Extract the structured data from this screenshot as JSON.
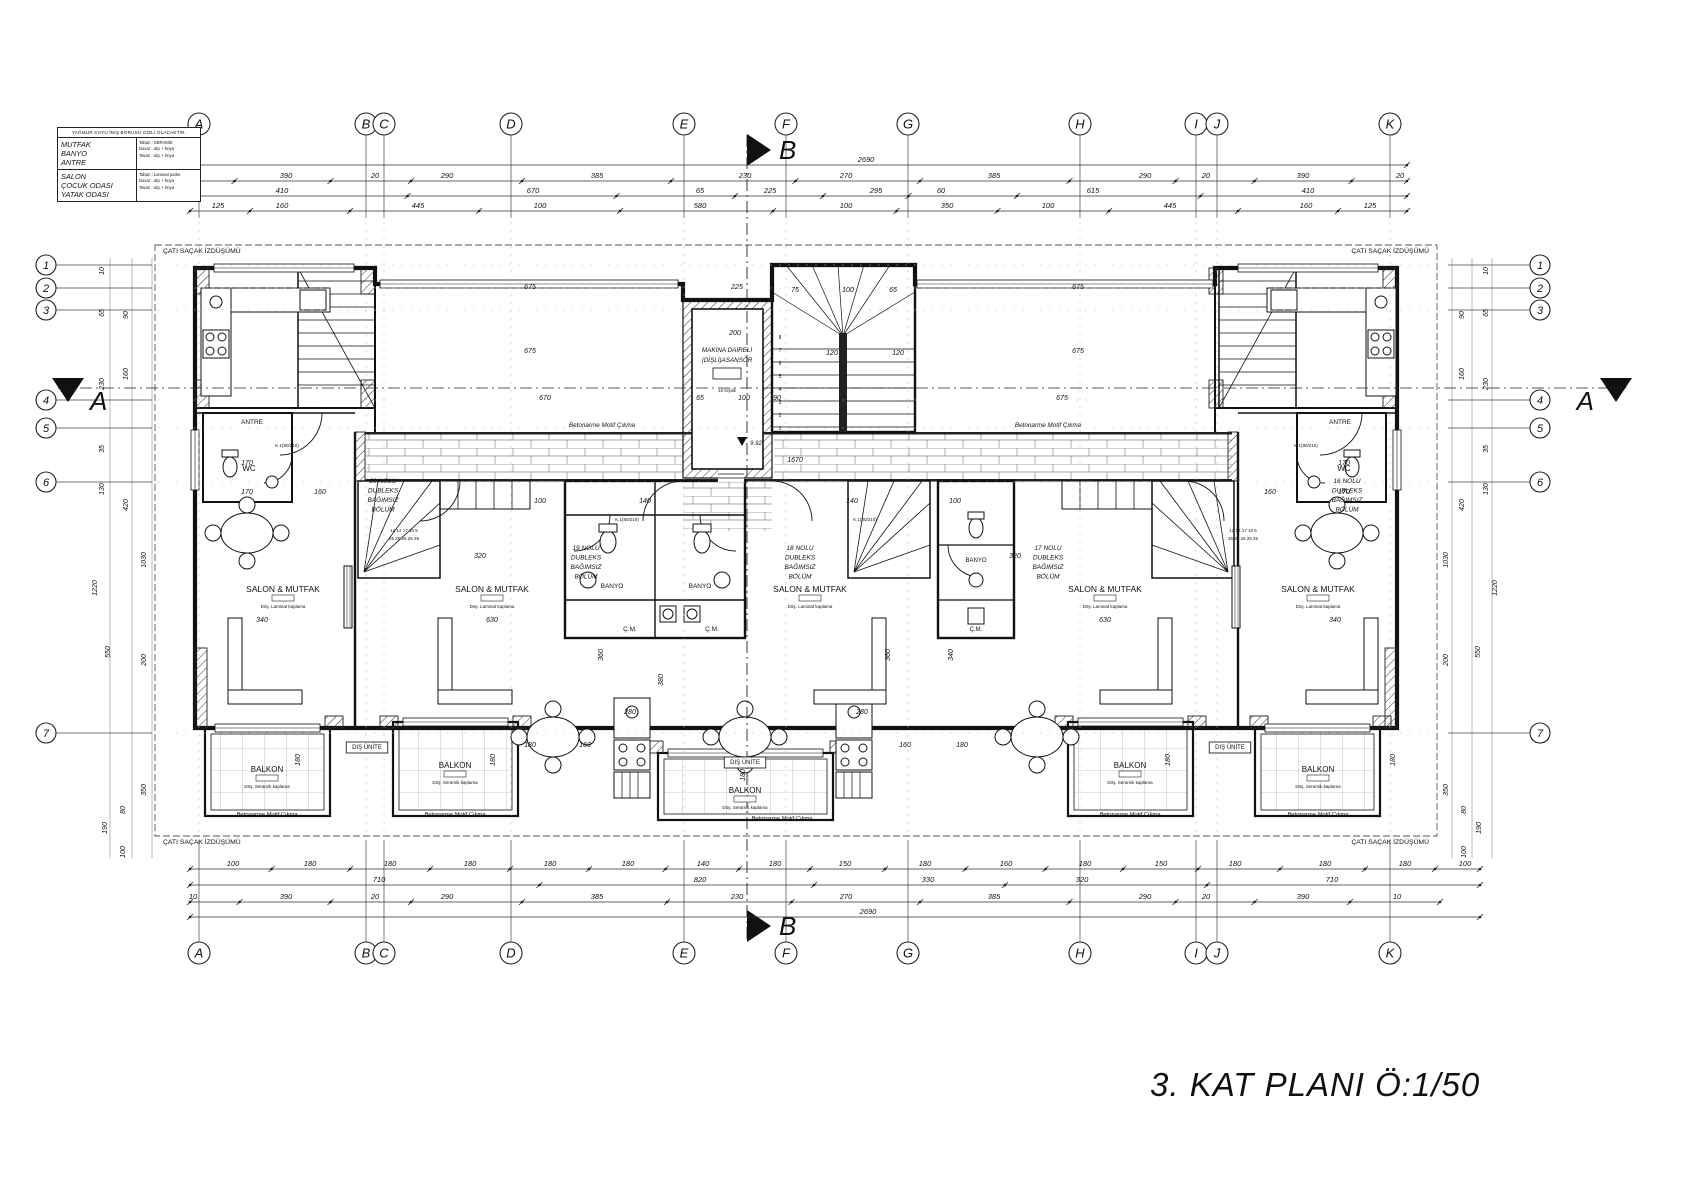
{
  "title": {
    "text": "3. KAT PLANI  Ö:1/50"
  },
  "legend": {
    "header": "YAĞMUR SUYU İNİŞ BORUSU GİZLİ OLACAKTIR.",
    "rows": [
      {
        "rooms": "MUTFAK\nBANYO\nANTRE",
        "finish": "Taban : SERAMİK\nDuvar : alçı + boya\nTavan : alçı + boya"
      },
      {
        "rooms": "SALON\nÇOCUK ODASI\nYATAK ODASI",
        "finish": "Taban : Laminat parke\nDuvar : alçı + boya\nTavan : alçı + boya"
      }
    ]
  },
  "axes": {
    "top_y": 124,
    "bottom_y": 953,
    "left_x": 46,
    "right_x": 1540,
    "letters": [
      {
        "label": "A",
        "x": 199
      },
      {
        "label": "B",
        "x": 366
      },
      {
        "label": "C",
        "x": 384
      },
      {
        "label": "D",
        "x": 511
      },
      {
        "label": "E",
        "x": 684
      },
      {
        "label": "F",
        "x": 786
      },
      {
        "label": "G",
        "x": 908
      },
      {
        "label": "H",
        "x": 1080
      },
      {
        "label": "I",
        "x": 1196
      },
      {
        "label": "J",
        "x": 1217
      },
      {
        "label": "K",
        "x": 1390
      }
    ],
    "numbers": [
      {
        "label": "1",
        "y": 265
      },
      {
        "label": "2",
        "y": 288
      },
      {
        "label": "3",
        "y": 310
      },
      {
        "label": "4",
        "y": 400
      },
      {
        "label": "5",
        "y": 428
      },
      {
        "label": "6",
        "y": 482
      },
      {
        "label": "7",
        "y": 733
      }
    ]
  },
  "sections": {
    "top": {
      "label": "B",
      "x": 747,
      "y": 150
    },
    "bottom": {
      "label": "B",
      "x": 747,
      "y": 926
    },
    "left": {
      "label": "A",
      "x": 68,
      "y": 388
    },
    "right": {
      "label": "A",
      "x": 1616,
      "y": 388
    }
  },
  "dim_rows": [
    {
      "y": 162,
      "x1": 190,
      "x2": 1407,
      "items": [
        {
          "t": "2690",
          "x": 866
        }
      ]
    },
    {
      "y": 178,
      "x1": 190,
      "x2": 1407,
      "items": [
        {
          "t": "20",
          "x": 183
        },
        {
          "t": "390",
          "x": 286
        },
        {
          "t": "20",
          "x": 375
        },
        {
          "t": "290",
          "x": 447
        },
        {
          "t": "385",
          "x": 597
        },
        {
          "t": "230",
          "x": 745
        },
        {
          "t": "270",
          "x": 846
        },
        {
          "t": "385",
          "x": 994
        },
        {
          "t": "290",
          "x": 1145
        },
        {
          "t": "20",
          "x": 1206
        },
        {
          "t": "390",
          "x": 1303
        },
        {
          "t": "20",
          "x": 1400
        }
      ]
    },
    {
      "y": 193,
      "x1": 190,
      "x2": 1407,
      "items": [
        {
          "t": "410",
          "x": 282
        },
        {
          "t": "670",
          "x": 533
        },
        {
          "t": "65",
          "x": 700
        },
        {
          "t": "225",
          "x": 770
        },
        {
          "t": "295",
          "x": 876
        },
        {
          "t": "60",
          "x": 941
        },
        {
          "t": "615",
          "x": 1093
        },
        {
          "t": "410",
          "x": 1308
        }
      ]
    },
    {
      "y": 208,
      "x1": 190,
      "x2": 1407,
      "items": [
        {
          "t": "125",
          "x": 218
        },
        {
          "t": "160",
          "x": 282
        },
        {
          "t": "445",
          "x": 418
        },
        {
          "t": "100",
          "x": 540
        },
        {
          "t": "580",
          "x": 700
        },
        {
          "t": "100",
          "x": 846
        },
        {
          "t": "350",
          "x": 947
        },
        {
          "t": "100",
          "x": 1048
        },
        {
          "t": "445",
          "x": 1170
        },
        {
          "t": "160",
          "x": 1306
        },
        {
          "t": "125",
          "x": 1370
        }
      ]
    },
    {
      "y": 866,
      "x1": 190,
      "x2": 1480,
      "items": [
        {
          "t": "100",
          "x": 233
        },
        {
          "t": "180",
          "x": 310
        },
        {
          "t": "180",
          "x": 390
        },
        {
          "t": "180",
          "x": 470
        },
        {
          "t": "180",
          "x": 550
        },
        {
          "t": "180",
          "x": 628
        },
        {
          "t": "140",
          "x": 703
        },
        {
          "t": "180",
          "x": 775
        },
        {
          "t": "150",
          "x": 845
        },
        {
          "t": "180",
          "x": 925
        },
        {
          "t": "160",
          "x": 1006
        },
        {
          "t": "180",
          "x": 1085
        },
        {
          "t": "150",
          "x": 1161
        },
        {
          "t": "180",
          "x": 1235
        },
        {
          "t": "180",
          "x": 1325
        },
        {
          "t": "180",
          "x": 1405
        },
        {
          "t": "100",
          "x": 1465
        }
      ]
    },
    {
      "y": 882,
      "x1": 190,
      "x2": 1480,
      "items": [
        {
          "t": "710",
          "x": 379
        },
        {
          "t": "820",
          "x": 700
        },
        {
          "t": "330",
          "x": 928
        },
        {
          "t": "320",
          "x": 1082
        },
        {
          "t": "710",
          "x": 1332
        }
      ]
    },
    {
      "y": 899,
      "x1": 190,
      "x2": 1440,
      "items": [
        {
          "t": "10",
          "x": 193
        },
        {
          "t": "390",
          "x": 286
        },
        {
          "t": "20",
          "x": 375
        },
        {
          "t": "290",
          "x": 447
        },
        {
          "t": "385",
          "x": 597
        },
        {
          "t": "230",
          "x": 737
        },
        {
          "t": "270",
          "x": 846
        },
        {
          "t": "385",
          "x": 994
        },
        {
          "t": "290",
          "x": 1145
        },
        {
          "t": "20",
          "x": 1206
        },
        {
          "t": "390",
          "x": 1303
        },
        {
          "t": "10",
          "x": 1397
        }
      ]
    },
    {
      "y": 914,
      "x1": 190,
      "x2": 1480,
      "items": [
        {
          "t": "2690",
          "x": 868
        }
      ]
    }
  ],
  "left_vdims": [
    {
      "t": "10",
      "x": 104,
      "y": 271
    },
    {
      "t": "65",
      "x": 104,
      "y": 313
    },
    {
      "t": "90",
      "x": 128,
      "y": 315
    },
    {
      "t": "230",
      "x": 104,
      "y": 384
    },
    {
      "t": "160",
      "x": 128,
      "y": 374
    },
    {
      "t": "35",
      "x": 104,
      "y": 449
    },
    {
      "t": "130",
      "x": 104,
      "y": 489
    },
    {
      "t": "420",
      "x": 128,
      "y": 505
    },
    {
      "t": "1220",
      "x": 97,
      "y": 588
    },
    {
      "t": "1030",
      "x": 146,
      "y": 560
    },
    {
      "t": "550",
      "x": 110,
      "y": 652
    },
    {
      "t": "200",
      "x": 146,
      "y": 660
    },
    {
      "t": "350",
      "x": 146,
      "y": 790
    },
    {
      "t": "80",
      "x": 125,
      "y": 810
    },
    {
      "t": "190",
      "x": 107,
      "y": 828
    },
    {
      "t": "100",
      "x": 125,
      "y": 852
    }
  ],
  "right_vdims": [
    {
      "t": "10",
      "x": 1488,
      "y": 271
    },
    {
      "t": "65",
      "x": 1488,
      "y": 313
    },
    {
      "t": "90",
      "x": 1464,
      "y": 315
    },
    {
      "t": "230",
      "x": 1488,
      "y": 384
    },
    {
      "t": "160",
      "x": 1464,
      "y": 374
    },
    {
      "t": "35",
      "x": 1488,
      "y": 449
    },
    {
      "t": "130",
      "x": 1488,
      "y": 489
    },
    {
      "t": "420",
      "x": 1464,
      "y": 505
    },
    {
      "t": "1220",
      "x": 1497,
      "y": 588
    },
    {
      "t": "1030",
      "x": 1448,
      "y": 560
    },
    {
      "t": "550",
      "x": 1480,
      "y": 652
    },
    {
      "t": "200",
      "x": 1448,
      "y": 660
    },
    {
      "t": "350",
      "x": 1448,
      "y": 790
    },
    {
      "t": "80",
      "x": 1466,
      "y": 810
    },
    {
      "t": "190",
      "x": 1481,
      "y": 828
    },
    {
      "t": "100",
      "x": 1466,
      "y": 852
    }
  ],
  "interior_dims": [
    {
      "t": "675",
      "x": 530,
      "y": 289
    },
    {
      "t": "225",
      "x": 737,
      "y": 289
    },
    {
      "t": "675",
      "x": 1078,
      "y": 289
    },
    {
      "t": "75",
      "x": 795,
      "y": 292
    },
    {
      "t": "100",
      "x": 848,
      "y": 292
    },
    {
      "t": "65",
      "x": 893,
      "y": 292
    },
    {
      "t": "200",
      "x": 735,
      "y": 335
    },
    {
      "t": "675",
      "x": 530,
      "y": 353
    },
    {
      "t": "675",
      "x": 1078,
      "y": 353
    },
    {
      "t": "120",
      "x": 832,
      "y": 355
    },
    {
      "t": "120",
      "x": 898,
      "y": 355
    },
    {
      "t": "670",
      "x": 545,
      "y": 400
    },
    {
      "t": "65",
      "x": 700,
      "y": 400
    },
    {
      "t": "100",
      "x": 744,
      "y": 400
    },
    {
      "t": "90",
      "x": 777,
      "y": 400
    },
    {
      "t": "675",
      "x": 1062,
      "y": 400
    },
    {
      "t": "1670",
      "x": 795,
      "y": 462
    },
    {
      "t": "170",
      "x": 247,
      "y": 465
    },
    {
      "t": "170",
      "x": 1344,
      "y": 465
    },
    {
      "t": "170",
      "x": 247,
      "y": 494
    },
    {
      "t": "160",
      "x": 320,
      "y": 494
    },
    {
      "t": "160",
      "x": 1270,
      "y": 494
    },
    {
      "t": "170",
      "x": 1344,
      "y": 494
    },
    {
      "t": "100",
      "x": 540,
      "y": 503
    },
    {
      "t": "140",
      "x": 645,
      "y": 503
    },
    {
      "t": "140",
      "x": 852,
      "y": 503
    },
    {
      "t": "100",
      "x": 955,
      "y": 503
    },
    {
      "t": "320",
      "x": 480,
      "y": 558
    },
    {
      "t": "320",
      "x": 1015,
      "y": 558
    },
    {
      "t": "340",
      "x": 262,
      "y": 622
    },
    {
      "t": "630",
      "x": 492,
      "y": 622
    },
    {
      "t": "630",
      "x": 1105,
      "y": 622
    },
    {
      "t": "340",
      "x": 1335,
      "y": 622
    },
    {
      "t": "280",
      "x": 630,
      "y": 714
    },
    {
      "t": "280",
      "x": 862,
      "y": 714
    },
    {
      "t": "180",
      "x": 530,
      "y": 747
    },
    {
      "t": "160",
      "x": 585,
      "y": 747
    },
    {
      "t": "160",
      "x": 905,
      "y": 747
    },
    {
      "t": "180",
      "x": 962,
      "y": 747
    },
    {
      "t": "360",
      "x": 603,
      "y": 655,
      "rot": true
    },
    {
      "t": "360",
      "x": 890,
      "y": 655,
      "rot": true
    },
    {
      "t": "380",
      "x": 663,
      "y": 680,
      "rot": true
    },
    {
      "t": "340",
      "x": 953,
      "y": 655,
      "rot": true
    },
    {
      "t": "180",
      "x": 300,
      "y": 760,
      "rot": true
    },
    {
      "t": "180",
      "x": 495,
      "y": 760,
      "rot": true
    },
    {
      "t": "180",
      "x": 745,
      "y": 775,
      "rot": true
    },
    {
      "t": "180",
      "x": 1170,
      "y": 760,
      "rot": true
    },
    {
      "t": "180",
      "x": 1395,
      "y": 760,
      "rot": true
    }
  ],
  "labels": [
    {
      "t": "SALON & MUTFAK",
      "x": 283,
      "y": 592,
      "fs": 8.5,
      "sub": "Döş. Laminat kaplama"
    },
    {
      "t": "SALON & MUTFAK",
      "x": 492,
      "y": 592,
      "fs": 8.5,
      "sub": "Döş. Laminat kaplama"
    },
    {
      "t": "SALON & MUTFAK",
      "x": 810,
      "y": 592,
      "fs": 8.5,
      "sub": "Döş. Laminat kaplama"
    },
    {
      "t": "SALON & MUTFAK",
      "x": 1105,
      "y": 592,
      "fs": 8.5,
      "sub": "Döş. Laminat kaplama"
    },
    {
      "t": "SALON & MUTFAK",
      "x": 1318,
      "y": 592,
      "fs": 8.5,
      "sub": "Döş. Laminat kaplama"
    },
    {
      "t": "BALKON",
      "x": 267,
      "y": 772,
      "fs": 8,
      "sub": "Döş. Seramik kaplama"
    },
    {
      "t": "BALKON",
      "x": 455,
      "y": 768,
      "fs": 8,
      "sub": "Döş. Seramik kaplama"
    },
    {
      "t": "BALKON",
      "x": 745,
      "y": 793,
      "fs": 8,
      "sub": "Döş. Seramik kaplama"
    },
    {
      "t": "BALKON",
      "x": 1130,
      "y": 768,
      "fs": 8,
      "sub": "Döş. Seramik kaplama"
    },
    {
      "t": "BALKON",
      "x": 1318,
      "y": 772,
      "fs": 8,
      "sub": "Döş. Seramik kaplama"
    },
    {
      "t": "BANYO",
      "x": 612,
      "y": 588,
      "fs": 6.5
    },
    {
      "t": "BANYO",
      "x": 700,
      "y": 588,
      "fs": 6.5
    },
    {
      "t": "BANYO",
      "x": 976,
      "y": 562,
      "fs": 6
    },
    {
      "t": "Ç.M.",
      "x": 630,
      "y": 631,
      "fs": 6.5
    },
    {
      "t": "Ç.M.",
      "x": 712,
      "y": 631,
      "fs": 6.5
    },
    {
      "t": "Ç.M.",
      "x": 976,
      "y": 631,
      "fs": 6
    },
    {
      "t": "WC",
      "x": 249,
      "y": 471,
      "fs": 8
    },
    {
      "t": "WC",
      "x": 1344,
      "y": 471,
      "fs": 8
    },
    {
      "t": "ANTRE",
      "x": 252,
      "y": 424,
      "fs": 6.5
    },
    {
      "t": "ANTRE",
      "x": 1340,
      "y": 424,
      "fs": 6.5
    },
    {
      "t": "DIŞ ÜNİTE",
      "x": 367,
      "y": 749,
      "fs": 6,
      "box": true
    },
    {
      "t": "DIŞ ÜNİTE",
      "x": 745,
      "y": 764,
      "fs": 6,
      "box": true
    },
    {
      "t": "DIŞ ÜNİTE",
      "x": 1230,
      "y": 749,
      "fs": 6,
      "box": true
    },
    {
      "lines": [
        "20 NOLU",
        "DUBLEKS",
        "BAĞIMSIZ",
        "BÖLÜM"
      ],
      "x": 383,
      "y": 483,
      "fs": 6.5,
      "lh": 9.5
    },
    {
      "lines": [
        "19 NOLU",
        "DUBLEKS",
        "BAĞIMSIZ",
        "BÖLÜM"
      ],
      "x": 586,
      "y": 550,
      "fs": 6.5,
      "lh": 9.5
    },
    {
      "lines": [
        "18 NOLU",
        "DUBLEKS",
        "BAĞIMSIZ",
        "BÖLÜM"
      ],
      "x": 800,
      "y": 550,
      "fs": 6.5,
      "lh": 9.5
    },
    {
      "lines": [
        "17 NOLU",
        "DUBLEKS",
        "BAĞIMSIZ",
        "BÖLÜM"
      ],
      "x": 1048,
      "y": 550,
      "fs": 6.5,
      "lh": 9.5
    },
    {
      "lines": [
        "16 NOLU",
        "DUBLEKS",
        "BAĞIMSIZ",
        "BÖLÜM"
      ],
      "x": 1347,
      "y": 483,
      "fs": 6.5,
      "lh": 9.5
    },
    {
      "lines": [
        "MAKİNA DAİRELİ",
        "(DİŞLİ)ASANSÖR"
      ],
      "x": 727,
      "y": 352,
      "fs": 6.3,
      "lh": 10
    },
    {
      "t": "10 Kişilik",
      "x": 727,
      "y": 392,
      "fs": 4.5
    },
    {
      "t": "ÇATI SAÇAK İZDÜŞÜMÜ",
      "x": 163,
      "y": 253,
      "fs": 6.8,
      "anchor": "start"
    },
    {
      "t": "ÇATI SAÇAK İZDÜŞÜMÜ",
      "x": 1429,
      "y": 253,
      "fs": 6.8,
      "anchor": "end"
    },
    {
      "t": "ÇATI SAÇAK İZDÜŞÜMÜ",
      "x": 163,
      "y": 844,
      "fs": 6.8,
      "anchor": "start"
    },
    {
      "t": "ÇATI SAÇAK İZDÜŞÜMÜ",
      "x": 1429,
      "y": 844,
      "fs": 6.8,
      "anchor": "end"
    },
    {
      "t": "Betonarme Motif Çıkma",
      "x": 602,
      "y": 427,
      "fs": 6.3,
      "it": true
    },
    {
      "t": "Betonarme Motif Çıkma",
      "x": 1048,
      "y": 427,
      "fs": 6.3,
      "it": true
    },
    {
      "t": "Betonarme Motif Çıkma",
      "x": 267,
      "y": 816,
      "fs": 5.8,
      "it": true
    },
    {
      "t": "Betonarme Motif Çıkma",
      "x": 455,
      "y": 816,
      "fs": 5.8,
      "it": true
    },
    {
      "t": "Betonarme Motif Çıkma",
      "x": 782,
      "y": 820,
      "fs": 5.8,
      "it": true
    },
    {
      "t": "Betonarme Motif Çıkma",
      "x": 1130,
      "y": 816,
      "fs": 5.8,
      "it": true
    },
    {
      "t": "Betonarme Motif Çıkma",
      "x": 1318,
      "y": 816,
      "fs": 5.8,
      "it": true
    },
    {
      "t": "K.1(80/210)",
      "x": 627,
      "y": 521,
      "fs": 4.5
    },
    {
      "t": "K.1(80/210)",
      "x": 865,
      "y": 521,
      "fs": 4.5
    },
    {
      "t": "K.1(80/210)",
      "x": 287,
      "y": 447,
      "fs": 4.5
    },
    {
      "t": "K.1(80/210)",
      "x": 1306,
      "y": 447,
      "fs": 4.5
    },
    {
      "t": "12 12 17 10 5",
      "x": 404,
      "y": 532,
      "fs": 4.5
    },
    {
      "t": "25 25 25 25 25",
      "x": 404,
      "y": 540,
      "fs": 4.5
    },
    {
      "t": "12 12 17 10 5",
      "x": 1243,
      "y": 532,
      "fs": 4.5
    },
    {
      "t": "25 25 25 25 25",
      "x": 1243,
      "y": 540,
      "fs": 4.5
    },
    {
      "t": "9.92",
      "x": 756,
      "y": 445,
      "fs": 6,
      "it": true
    },
    {
      "t": "8",
      "x": 780,
      "y": 339,
      "fs": 5
    },
    {
      "t": "7",
      "x": 780,
      "y": 352,
      "fs": 5
    },
    {
      "t": "6",
      "x": 780,
      "y": 365,
      "fs": 5
    },
    {
      "t": "5",
      "x": 780,
      "y": 378,
      "fs": 5
    },
    {
      "t": "4",
      "x": 780,
      "y": 391,
      "fs": 5
    },
    {
      "t": "3",
      "x": 780,
      "y": 404,
      "fs": 5
    },
    {
      "t": "2",
      "x": 780,
      "y": 417,
      "fs": 5
    },
    {
      "t": "1",
      "x": 780,
      "y": 430,
      "fs": 5
    }
  ]
}
